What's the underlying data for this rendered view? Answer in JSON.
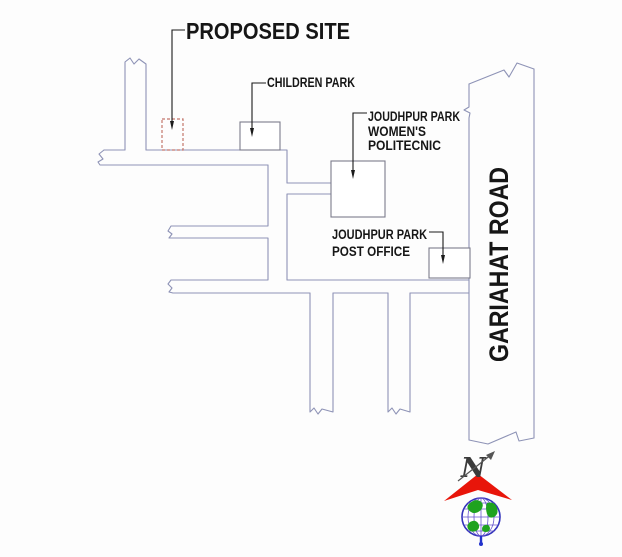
{
  "map": {
    "type": "site-location-map",
    "labels": {
      "proposed_site": "PROPOSED SITE",
      "children_park": "CHILDREN PARK",
      "polytechnic_line1": "JOUDHPUR PARK",
      "polytechnic_line2": "WOMEN'S",
      "polytechnic_line3": "POLITECNIC",
      "post_office_line1": "JOUDHPUR PARK",
      "post_office_line2": "POST OFFICE",
      "gariahat_road": "GARIAHAT ROAD"
    },
    "compass": {
      "north_letter": "N"
    },
    "colors": {
      "road_line": "#8e93b6",
      "landmark_line": "#7c7c8c",
      "proposed_site_dash": "#c4766b",
      "leader_line": "#1a1a1a",
      "compass_arrow_red": "#e8150a",
      "globe_outline_blue": "#3333bb",
      "globe_grid_purple": "#6655cc",
      "globe_land_green": "#1fa31f",
      "globe_tail_blue": "#2233cc",
      "text": "#161616",
      "background": "#fdfdfd"
    }
  }
}
